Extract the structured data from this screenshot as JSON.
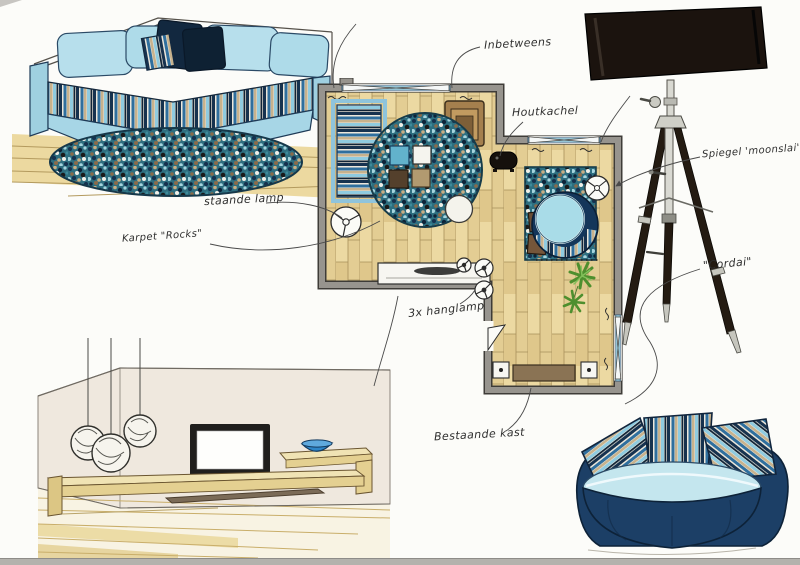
{
  "annotations": {
    "inbetweens": {
      "text": "Inbetweens"
    },
    "houtkachel": {
      "text": "Houtkachel"
    },
    "spiegel": {
      "text": "Spiegel 'moonslai'"
    },
    "staande_lamp": {
      "text": "staande lamp"
    },
    "karpet": {
      "text": "Karpet \"Rocks\""
    },
    "hanglamp": {
      "text": "3x hanglamp"
    },
    "bestaande_kast": {
      "text": "Bestaande kast"
    },
    "cordai": {
      "text": "\"Cordai\""
    }
  },
  "palette": {
    "paper": "#fcfcf9",
    "ink": "#2e2e2e",
    "wall_gray": "#97948e",
    "wood": "#ecd9a2",
    "wood_line": "#a8905a",
    "sofa_light_blue": "#a7d6e6",
    "navy": "#16324f",
    "steel_blue": "#2f6f9e",
    "tan": "#c7b28d",
    "pale_blue": "#8fcbe0",
    "rug_teal": "#2e6f80",
    "lamp_shade_black": "#1b130e",
    "bowl_blue": "#2e86c8",
    "plant_green": "#5d9b3d",
    "scan_edge_gray": "#b4b2ad"
  },
  "sketch_items": {
    "corner_sofa": "corner-sofa-with-striped-cushions",
    "round_rug": "round-mottled-rug",
    "floor_plan": "living-room-floor-plan",
    "tripod_lamp": "tripod-floor-lamp",
    "tv_wall_unit": "tv-wall-with-floating-shelf",
    "round_loveseat": "round-loveseat-with-striped-pillows"
  }
}
